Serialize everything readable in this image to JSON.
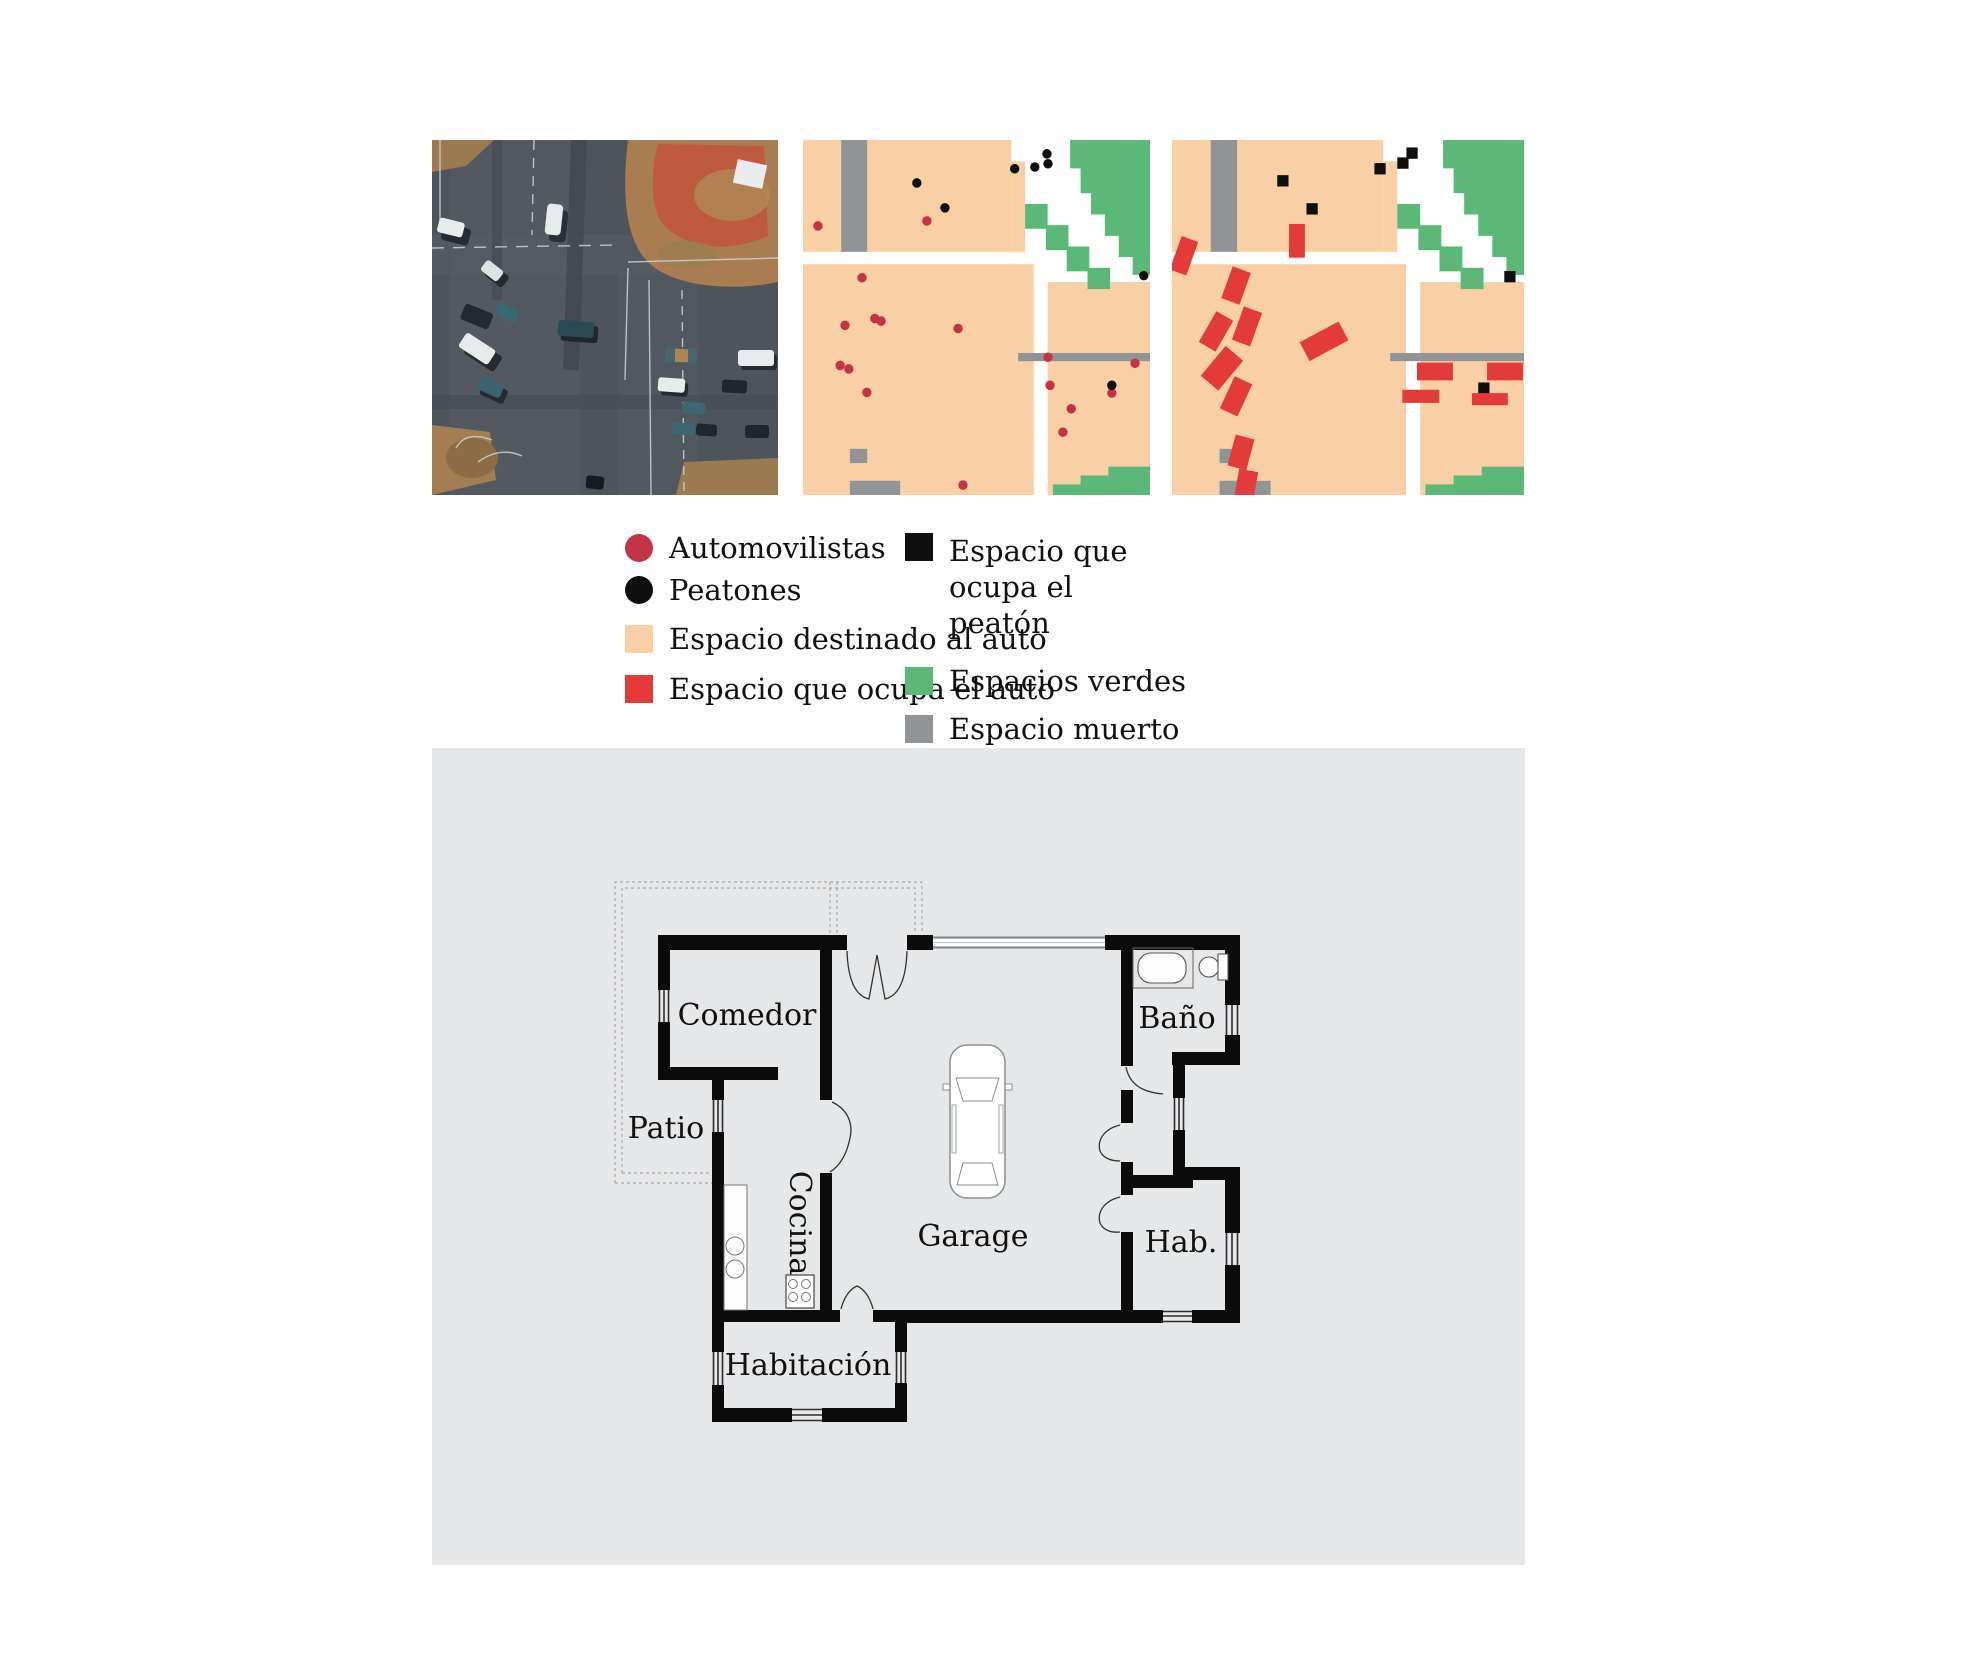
{
  "colors": {
    "peach": "#f9cfa5",
    "red_square": "#e23b3a",
    "red_dot": "#c53346",
    "black": "#0f0f0f",
    "green": "#5cb878",
    "gray": "#909496",
    "panel_background": "#e6e7e8",
    "wall_black": "#0b0b0b",
    "asphalt": "#4e545c",
    "dirt": "#a97c52",
    "dirt_red": "#bf5a41"
  },
  "legend": {
    "left": [
      {
        "type": "circle",
        "color": "red_dot",
        "label": "Automovilistas"
      },
      {
        "type": "circle",
        "color": "black",
        "label": "Peatones"
      },
      {
        "type": "square",
        "color": "peach",
        "label": "Espacio destinado al auto"
      },
      {
        "type": "square",
        "color": "red_square",
        "label": "Espacio que ocupa el auto"
      }
    ],
    "right": [
      {
        "type": "square",
        "color": "black",
        "label": "Espacio que ocupa el peatón",
        "wrap": true
      },
      {
        "type": "square",
        "color": "green",
        "label": "Espacios verdes"
      },
      {
        "type": "square",
        "color": "gray",
        "label": "Espacio muerto"
      }
    ]
  },
  "maps": {
    "base_shapes": [
      {
        "kind": "rect",
        "x": 0,
        "y": 0,
        "w": 60,
        "h": 31.5,
        "color": "peach"
      },
      {
        "kind": "poly",
        "pts": [
          [
            60,
            6
          ],
          [
            64,
            6
          ],
          [
            64,
            31.5
          ],
          [
            60,
            31.5
          ]
        ],
        "color": "peach"
      },
      {
        "kind": "rect",
        "x": 11,
        "y": 0,
        "w": 7.5,
        "h": 31.5,
        "color": "gray"
      },
      {
        "kind": "rect",
        "x": 0,
        "y": 35,
        "w": 66.5,
        "h": 65,
        "color": "peach"
      },
      {
        "kind": "rect",
        "x": 70.5,
        "y": 40,
        "w": 29.5,
        "h": 60,
        "color": "peach"
      },
      {
        "kind": "rect",
        "x": 70.5,
        "y": 60,
        "w": 29.5,
        "h": 2.3,
        "color": "gray"
      },
      {
        "kind": "rect",
        "x": 62,
        "y": 60,
        "w": 8.5,
        "h": 2.3,
        "color": "gray"
      },
      {
        "kind": "poly",
        "pts": [
          [
            77,
            0
          ],
          [
            100,
            0
          ],
          [
            100,
            38
          ],
          [
            95,
            38
          ],
          [
            95,
            33
          ],
          [
            91,
            33
          ],
          [
            91,
            27
          ],
          [
            87,
            27
          ],
          [
            87,
            21
          ],
          [
            83,
            21
          ],
          [
            83,
            15
          ],
          [
            80,
            15
          ],
          [
            80,
            8
          ],
          [
            77,
            8
          ]
        ],
        "color": "green"
      },
      {
        "kind": "rect",
        "x": 64,
        "y": 18,
        "w": 6.5,
        "h": 7,
        "color": "green"
      },
      {
        "kind": "rect",
        "x": 70,
        "y": 24,
        "w": 6.5,
        "h": 7,
        "color": "green"
      },
      {
        "kind": "rect",
        "x": 76,
        "y": 30,
        "w": 6.5,
        "h": 7,
        "color": "green"
      },
      {
        "kind": "rect",
        "x": 82,
        "y": 36,
        "w": 6.5,
        "h": 6,
        "color": "green"
      },
      {
        "kind": "rect",
        "x": 88,
        "y": 92,
        "w": 12,
        "h": 8,
        "color": "green"
      },
      {
        "kind": "rect",
        "x": 80,
        "y": 94.5,
        "w": 9,
        "h": 5.5,
        "color": "green"
      },
      {
        "kind": "rect",
        "x": 72,
        "y": 97,
        "w": 9,
        "h": 3,
        "color": "green"
      },
      {
        "kind": "rect",
        "x": 13.5,
        "y": 87,
        "w": 5,
        "h": 4,
        "color": "gray"
      },
      {
        "kind": "rect",
        "x": 13.5,
        "y": 96,
        "w": 14.5,
        "h": 4,
        "color": "gray"
      }
    ],
    "map1": {
      "red_dots": [
        [
          4.3,
          24.2
        ],
        [
          35.7,
          22.8
        ],
        [
          17,
          38.8
        ],
        [
          12.1,
          52.2
        ],
        [
          20.7,
          50.3
        ],
        [
          22.5,
          51
        ],
        [
          44.7,
          53.1
        ],
        [
          10.7,
          63.5
        ],
        [
          13.2,
          64.5
        ],
        [
          18.4,
          71.1
        ],
        [
          70.6,
          61.2
        ],
        [
          95.7,
          62.9
        ],
        [
          71.2,
          69.1
        ],
        [
          89,
          71.3
        ],
        [
          77.3,
          75.7
        ],
        [
          74.9,
          82.3
        ],
        [
          46.1,
          97.2
        ]
      ],
      "black_dots": [
        [
          32.8,
          12.1
        ],
        [
          40.9,
          19.1
        ],
        [
          61,
          8.1
        ],
        [
          66.8,
          7.6
        ],
        [
          70.3,
          3.9
        ],
        [
          70.6,
          6.7
        ],
        [
          98.2,
          38.2
        ],
        [
          89,
          69.1
        ]
      ]
    },
    "map2": {
      "black_squares": [
        [
          31.5,
          11.5
        ],
        [
          39.8,
          19.4
        ],
        [
          59.1,
          8.1
        ],
        [
          65.6,
          6.5
        ],
        [
          68.2,
          3.7
        ],
        [
          96,
          38.5
        ],
        [
          88.6,
          69.9
        ]
      ],
      "red_rects": [
        [
          35.5,
          28.4,
          4.5,
          9.5,
          0
        ],
        [
          3.4,
          32.6,
          5,
          10,
          20
        ],
        [
          18.2,
          41,
          5.5,
          9.5,
          20
        ],
        [
          12.5,
          53.9,
          5.5,
          10,
          30
        ],
        [
          21.3,
          52.5,
          5.5,
          10,
          20
        ],
        [
          14.2,
          64.3,
          6.5,
          11,
          40
        ],
        [
          43.2,
          56.7,
          12.5,
          6,
          -28
        ],
        [
          18.2,
          72.2,
          5.5,
          10,
          25
        ],
        [
          19.6,
          88,
          5.5,
          9,
          15
        ],
        [
          21,
          97.5,
          5.5,
          9,
          10
        ]
      ],
      "parking_rects": [
        [
          74.7,
          65.2,
          10.2,
          5
        ],
        [
          94.6,
          65.2,
          10.2,
          5
        ],
        [
          70.7,
          72.2,
          10.5,
          3.7
        ],
        [
          90.3,
          73,
          10.2,
          3.4
        ]
      ]
    }
  },
  "floor_plan": {
    "rooms": {
      "comedor": "Comedor",
      "patio": "Patio",
      "cocina": "Cocina",
      "garage": "Garage",
      "bano": "Baño",
      "hab": "Hab.",
      "habitacion": "Habitación"
    }
  }
}
